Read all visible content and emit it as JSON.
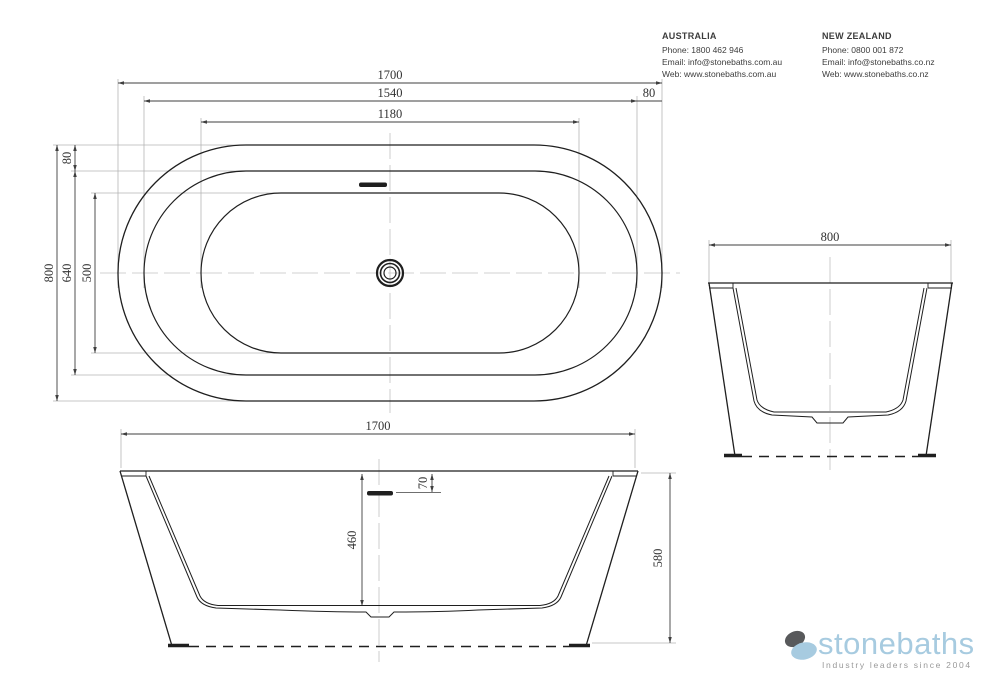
{
  "header": {
    "australia": {
      "title": "AUSTRALIA",
      "phone": "Phone: 1800 462 946",
      "email": "Email: info@stonebaths.com.au",
      "web": "Web: www.stonebaths.com.au"
    },
    "new_zealand": {
      "title": "NEW ZEALAND",
      "phone": "Phone: 0800 001 872",
      "email": "Email: info@stonebaths.co.nz",
      "web": "Web: www.stonebaths.co.nz"
    }
  },
  "drawing": {
    "plan_view": {
      "dim_length_overall": "1700",
      "dim_length_rim_inner": "1540",
      "dim_length_basin": "1180",
      "dim_rim_width_right": "80",
      "dim_width_overall": "800",
      "dim_width_rim_inner": "640",
      "dim_width_basin": "500",
      "dim_rim_width_top": "80"
    },
    "end_view": {
      "dim_width_overall": "800"
    },
    "front_view": {
      "dim_length_overall": "1700",
      "dim_overflow_drop": "70",
      "dim_depth_internal": "460",
      "dim_height_overall": "580"
    }
  },
  "logo": {
    "brand": "stonebaths",
    "tagline": "Industry leaders since 2004"
  },
  "colors": {
    "object_line": "#1f1f1f",
    "dimension_line": "#3f3f3f",
    "extension_line": "#b5b5b5",
    "logo_blue": "#a7cbe0",
    "logo_dark_gray": "#58595b",
    "tagline_gray": "#999999"
  }
}
